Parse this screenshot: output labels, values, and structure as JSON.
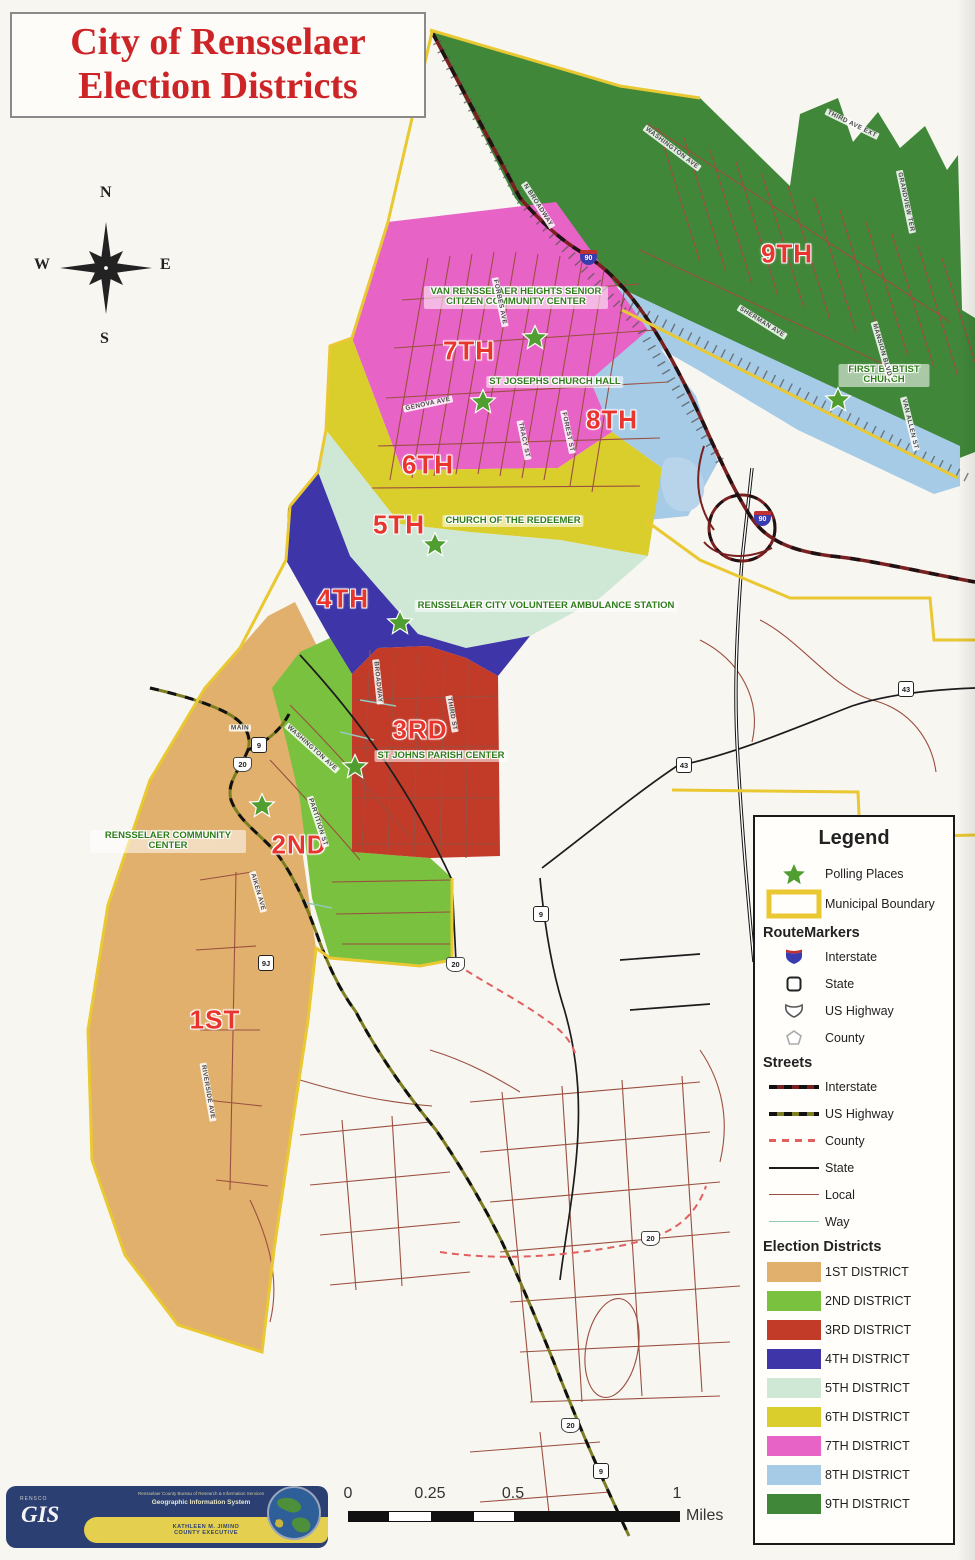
{
  "title": {
    "line1": "City of Rensselaer",
    "line2": "Election Districts"
  },
  "compass": {
    "n": "N",
    "e": "E",
    "s": "S",
    "w": "W"
  },
  "map": {
    "district_labels": {
      "d1": "1ST",
      "d2": "2ND",
      "d3": "3RD",
      "d4": "4TH",
      "d5": "5TH",
      "d6": "6TH",
      "d7": "7TH",
      "d8": "8TH",
      "d9": "9TH"
    },
    "polling_places": {
      "van_rensselaer": "VAN RENSSELAER HEIGHTS SENIOR CITIZEN COMMUNITY CENTER",
      "st_josephs": "ST JOSEPHS CHURCH HALL",
      "redeemer": "CHURCH OF THE REDEEMER",
      "ambulance": "RENSSELAER CITY VOLUNTEER AMBULANCE STATION",
      "st_johns": "ST JOHNS PARISH CENTER",
      "community": "RENSSELAER COMMUNITY CENTER",
      "baptist": "FIRST BABTIST CHURCH"
    },
    "markers": [
      {
        "type": "interstate",
        "text": "90"
      },
      {
        "type": "interstate",
        "text": "90"
      },
      {
        "type": "state",
        "text": "9"
      },
      {
        "type": "us",
        "text": "20"
      },
      {
        "type": "state",
        "text": "43"
      },
      {
        "type": "state",
        "text": "43"
      },
      {
        "type": "state",
        "text": "9"
      },
      {
        "type": "us",
        "text": "20"
      },
      {
        "type": "state",
        "text": "9J"
      },
      {
        "type": "us",
        "text": "20"
      },
      {
        "type": "us",
        "text": "20"
      },
      {
        "type": "state",
        "text": "9"
      }
    ],
    "street_labels": [
      "N BROADWAY",
      "WASHINGTON AVE",
      "THIRD AVE EXT",
      "GRANDVIEW TER",
      "SHERMAN AVE",
      "MANSION BLVD",
      "VAN ALLEN ST",
      "FORBES AVE",
      "GENOVA AVE",
      "TRACY ST",
      "FOREST ST",
      "BROADWAY",
      "WASHINGTON AVE",
      "MAIN",
      "PARTITION ST",
      "AIKEN AVE",
      "RIVERSIDE AVE",
      "THIRD ST"
    ]
  },
  "legend": {
    "title": "Legend",
    "polling": "Polling Places",
    "municipal": "Municipal Boundary",
    "route_markers_heading": "RouteMarkers",
    "route_marker_items": [
      "Interstate",
      "State",
      "US Highway",
      "County"
    ],
    "streets_heading": "Streets",
    "street_items": [
      "Interstate",
      "US Highway",
      "County",
      "State",
      "Local",
      "Way"
    ],
    "districts_heading": "Election Districts",
    "district_items": [
      "1ST DISTRICT",
      "2ND DISTRICT",
      "3RD DISTRICT",
      "4TH DISTRICT",
      "5TH DISTRICT",
      "6TH DISTRICT",
      "7TH DISTRICT",
      "8TH DISTRICT",
      "9TH DISTRICT"
    ]
  },
  "scale_bar": {
    "ticks": [
      "0",
      "0.25",
      "0.5",
      "1"
    ],
    "unit": "Miles"
  },
  "logo": {
    "agency": "RENSCO",
    "gis": "GIS",
    "line1": "Rensselaer County Bureau of Research & Information Services",
    "line2": "Geographic Information System",
    "exec_line1": "KATHLEEN M. JIMINO",
    "exec_line2": "COUNTY EXECUTIVE"
  },
  "colors": {
    "d1": "#e0b06c",
    "d2": "#79c13e",
    "d3": "#c23a28",
    "d4": "#3d35a8",
    "d5": "#cfe7d5",
    "d6": "#dace2d",
    "d7": "#e863c6",
    "d8": "#a6cbe7",
    "d9": "#41873a",
    "municipal_boundary": "#e9c832",
    "road_local": "#9b4f40",
    "road_state": "#1c1c1c",
    "road_county": "#e06060",
    "road_us": "#7d7d22",
    "road_interstate": "#7a2020",
    "road_way": "#96c7bb",
    "railroad": "#555555",
    "polling_star": "#4f9e2f",
    "district_label": "#e8352e",
    "polling_label": "#2f7d1a",
    "title_red": "#cc2427",
    "water": "#b8d4ea"
  }
}
